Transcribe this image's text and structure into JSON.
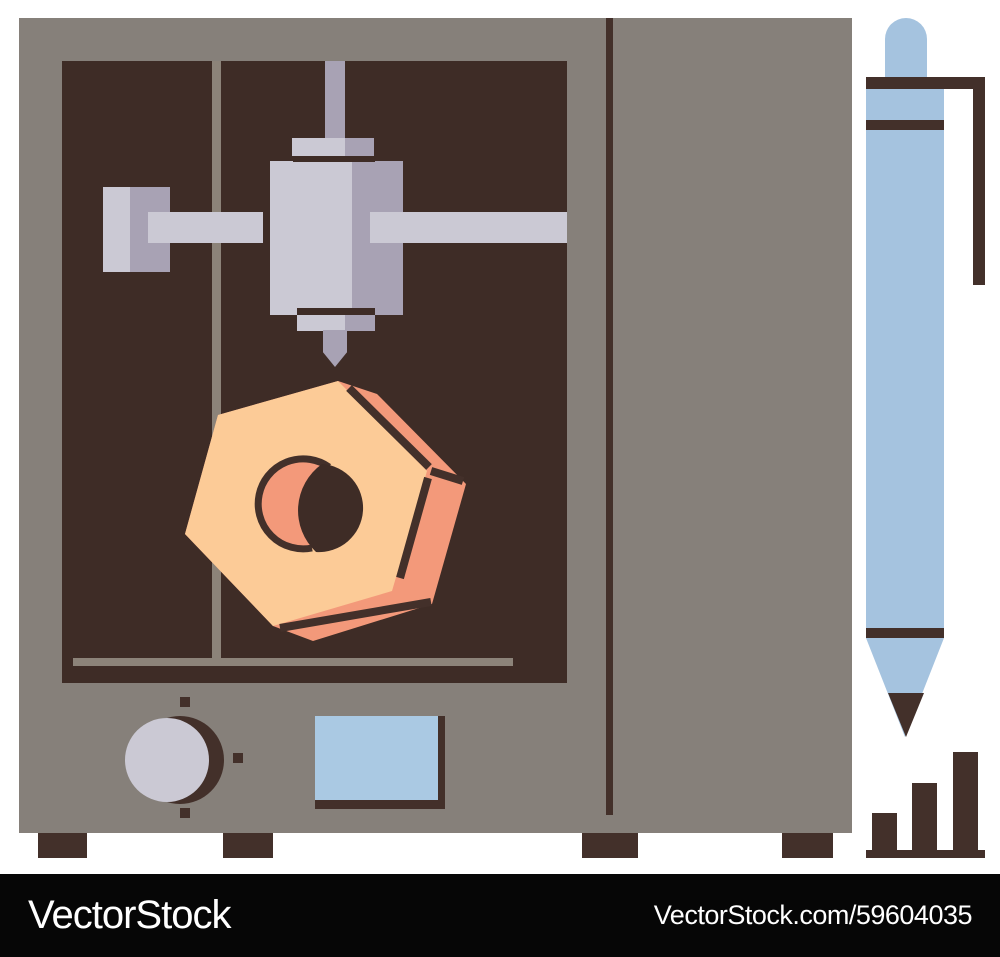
{
  "meta": {
    "description": "Flat vector illustration of a 3D printer printing an orange hexagonal nut, with a mechanical pencil and a rising bar chart icon beside it",
    "width_px": 1000,
    "height_px": 957
  },
  "watermark": {
    "brand": "VectorStock",
    "credit": "VectorStock.com/59604035"
  },
  "palette": {
    "bg": "#ffffff",
    "body": "#86807a",
    "window": "#3e2c26",
    "accent": "#43302a",
    "light": "#cbc9d4",
    "medium": "#a8a2b4",
    "frame": "#8c8379",
    "nut_face": "#fccb97",
    "nut_side": "#f3997a",
    "pen_blue": "#a5c3df",
    "screen_blue": "#aac9e3",
    "wm_bg": "#060606",
    "wm_text": "#ffffff"
  }
}
